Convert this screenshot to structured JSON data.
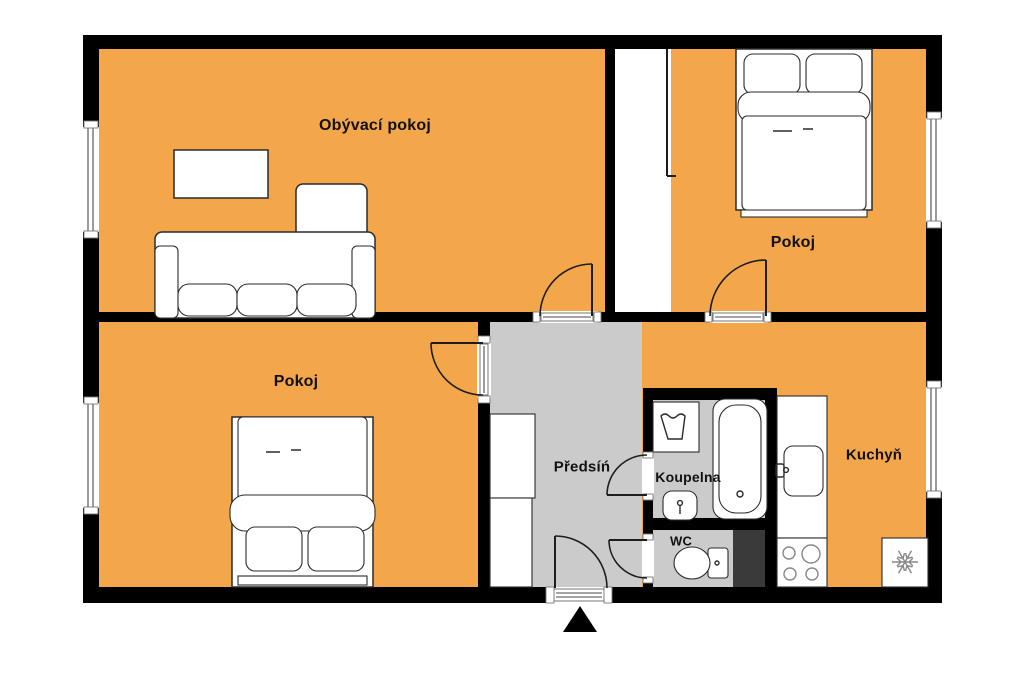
{
  "title": "Apartment floor plan",
  "colors": {
    "floor_orange": "#F3A64A",
    "floor_gray": "#CBCBCB",
    "wall": "#000000",
    "shaft_dark": "#3A3A3A",
    "furniture_outline": "#2B2B2B",
    "background": "#FFFFFF"
  },
  "rooms": [
    {
      "id": "living-room",
      "label": "Obývací pokoj"
    },
    {
      "id": "bedroom-top-right",
      "label": "Pokoj"
    },
    {
      "id": "bedroom-bottom-left",
      "label": "Pokoj"
    },
    {
      "id": "hallway",
      "label": "Předsíń"
    },
    {
      "id": "bathroom",
      "label": "Koupelna"
    },
    {
      "id": "wc",
      "label": "WC"
    },
    {
      "id": "kitchen",
      "label": "Kuchyň"
    }
  ],
  "furniture": [
    "coffee-table",
    "corner-sofa",
    "double-bed-top",
    "double-bed-bottom",
    "hallway-wardrobe",
    "built-in-closet",
    "washing-machine",
    "bathtub",
    "washbasin",
    "toilet",
    "kitchen-counter",
    "kitchen-sink",
    "stove",
    "fridge",
    "ventilation-shaft"
  ],
  "markers": [
    "entrance-arrow"
  ]
}
